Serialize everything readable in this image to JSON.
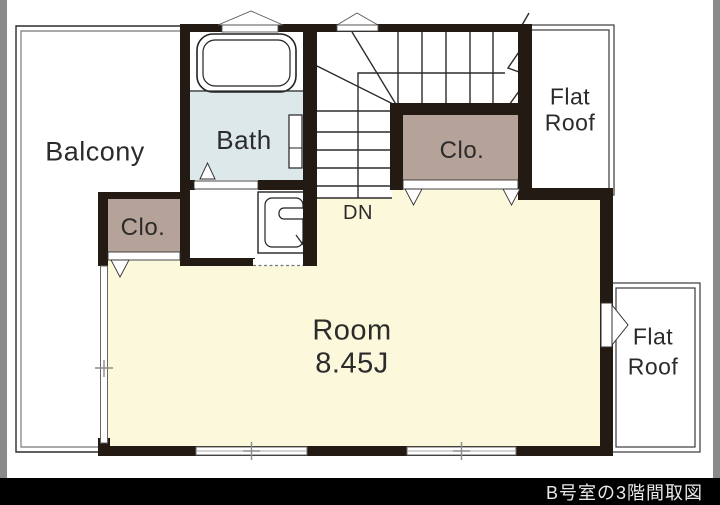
{
  "floorplan": {
    "balcony_label": "Balcony",
    "bath_label": "Bath",
    "closet_left_label": "Clo.",
    "closet_right_label": "Clo.",
    "stairs_down_label": "DN",
    "room_label": "Room",
    "room_size": "8.45J",
    "flat_roof_top": {
      "line1": "Flat",
      "line2": "Roof"
    },
    "flat_roof_bottom": {
      "line1": "Flat",
      "line2": "Roof"
    }
  },
  "caption": "B号室の3階間取図",
  "colors": {
    "wall": "#231a13",
    "room_floor": "#fbf8dc",
    "bath_floor": "#dce8ea",
    "closet_fill": "#b5a399",
    "plan_line": "#2b2b2b",
    "balcony_inner_line": "#8d8d8d",
    "caption_bg": "#000000",
    "caption_text": "#e9e9e9",
    "side_strip": "#8a8a8a"
  }
}
